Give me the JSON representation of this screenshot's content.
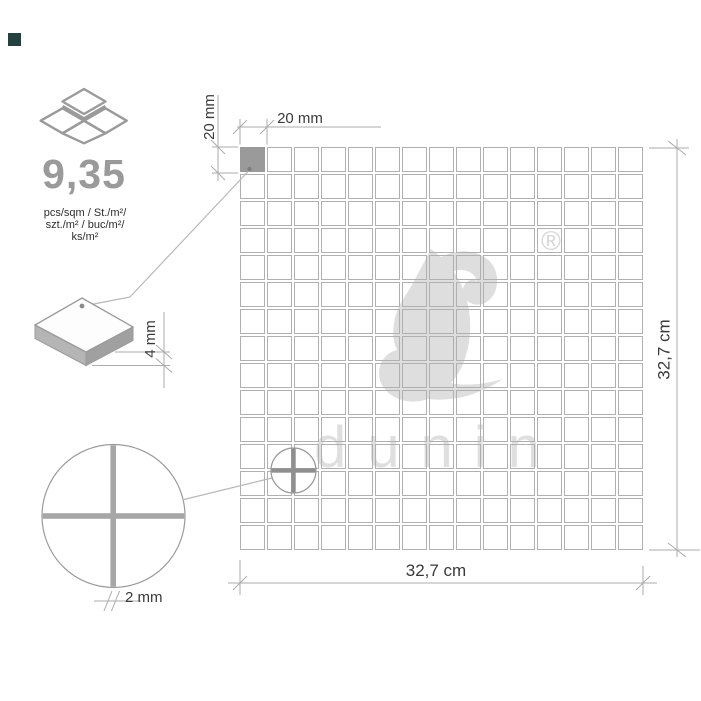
{
  "product": {
    "pieces_per_sqm": "9,35",
    "units": [
      "pcs/sqm / St./m²/",
      "szt./m² / buc/m²/",
      "ks/m²"
    ]
  },
  "dimensions": {
    "chip_width": "20 mm",
    "chip_height": "20 mm",
    "chip_thickness": "4 mm",
    "joint_width": "2 mm",
    "sheet_width": "32,7 cm",
    "sheet_height": "32,7 cm"
  },
  "grid": {
    "rows": 15,
    "cols": 15,
    "tile_size_px": 25,
    "gap_px": 2,
    "highlighted_tile": {
      "row": 0,
      "col": 0
    }
  },
  "watermark": {
    "brand": "dunin",
    "registered_mark": "®"
  },
  "colors": {
    "swatch": "#24413f",
    "accent_gray": "#9a9a9a",
    "tile_border": "#b0b0b0",
    "highlight_tile": "#9a9a9a",
    "line_gray": "#ababab",
    "leader_gray": "#b8b8b8",
    "text_dark": "#3a3a3a",
    "watermark_gray": "#dedede"
  }
}
